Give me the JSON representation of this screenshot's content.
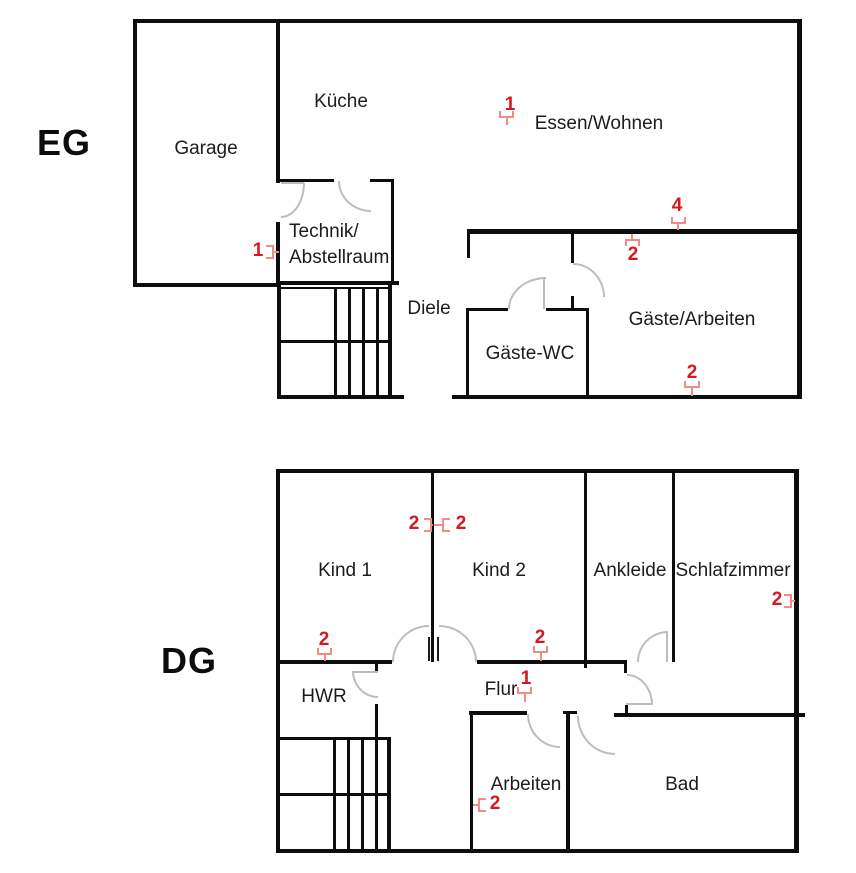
{
  "title": "Floor plan EG / DG",
  "colors": {
    "wall": "#0d0d0d",
    "door_arc": "#bdbdbd",
    "marker_number": "#d41920",
    "socket_symbol": "#ee8c85"
  },
  "floors": [
    {
      "label": "EG",
      "rooms": [
        {
          "name": "Garage"
        },
        {
          "name": "Küche"
        },
        {
          "name": "Essen/Wohnen"
        },
        {
          "name": "Technik/Abstellraum",
          "line1": "Technik/",
          "line2": "Abstellraum"
        },
        {
          "name": "Diele"
        },
        {
          "name": "Gäste-WC"
        },
        {
          "name": "Gäste/Arbeiten"
        }
      ],
      "markers": [
        {
          "count": "1",
          "symbol": "socket",
          "location": "Essen/Wohnen"
        },
        {
          "count": "1",
          "symbol": "socket",
          "location": "Technik/Abstellraum"
        },
        {
          "count": "4",
          "symbol": "socket",
          "location": "Essen/Wohnen wall top"
        },
        {
          "count": "2",
          "symbol": "socket",
          "location": "Gäste/Arbeiten wall top"
        },
        {
          "count": "2",
          "symbol": "socket",
          "location": "Gäste/Arbeiten wall bottom"
        }
      ]
    },
    {
      "label": "DG",
      "rooms": [
        {
          "name": "Kind 1"
        },
        {
          "name": "Kind 2"
        },
        {
          "name": "Ankleide"
        },
        {
          "name": "Schlafzimmer"
        },
        {
          "name": "HWR"
        },
        {
          "name": "Flur"
        },
        {
          "name": "Arbeiten"
        },
        {
          "name": "Bad"
        }
      ],
      "markers": [
        {
          "count": "2",
          "symbol": "socket",
          "location": "Kind 1 divider wall"
        },
        {
          "count": "2",
          "symbol": "socket",
          "location": "Kind 2 divider wall"
        },
        {
          "count": "2",
          "symbol": "socket",
          "location": "Kind 1 bottom wall"
        },
        {
          "count": "2",
          "symbol": "socket",
          "location": "Kind 2 bottom wall"
        },
        {
          "count": "1",
          "symbol": "socket",
          "location": "Flur"
        },
        {
          "count": "2",
          "symbol": "socket",
          "location": "Schlafzimmer right wall"
        },
        {
          "count": "2",
          "symbol": "socket",
          "location": "Arbeiten left wall"
        }
      ]
    }
  ]
}
